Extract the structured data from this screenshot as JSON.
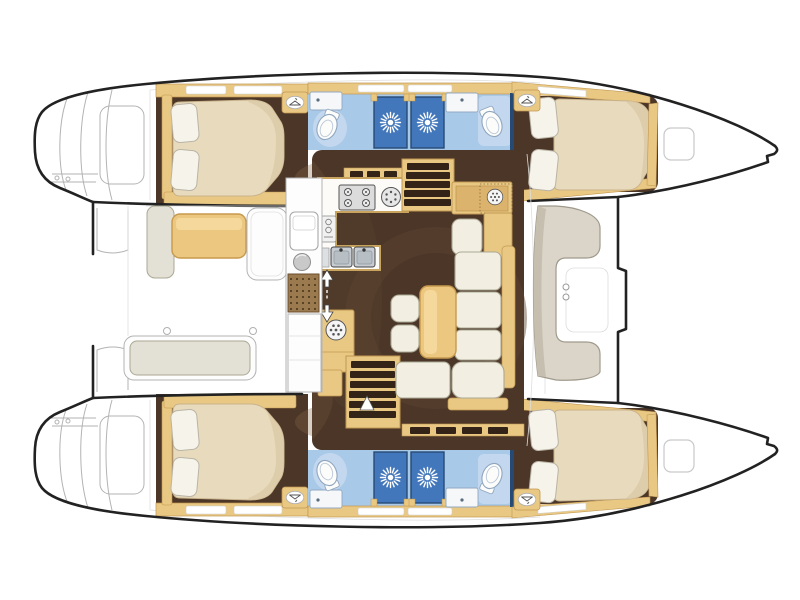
{
  "meta": {
    "label": "catamaran-interior-deck-plan",
    "view": "top-down",
    "bow_side": "right",
    "stern_side": "left"
  },
  "palette": {
    "outline": "#222222",
    "thin_line": "#b3b3b3",
    "seam": "#dedede",
    "deck_white": "#ffffff",
    "wood": "#e9c883",
    "wood_dark": "#c09752",
    "wood_hl": "#f4d89c",
    "floor": "#4b3628",
    "floor_shade": "#8a6a4c",
    "floor_deep": "#342417",
    "bed_cream": "#e8dbbd",
    "bed_edge": "#c9b28b",
    "bed_shade": "#d9c8a6",
    "pillow": "#f6f3ea",
    "pillow_edge": "#b9b4a6",
    "settee_cream": "#f2efe2",
    "settee_edge": "#aba894",
    "cushion_gray": "#e3e0d6",
    "bath_blue": "#a9c9e9",
    "bath_light": "#c3d8ee",
    "shower_blue": "#4377bb",
    "navy": "#274a74",
    "steel": "#c6ccd1",
    "panel_white": "#fdfdfd",
    "mat_brown": "#9b7a50",
    "mat_dot": "#463218"
  },
  "icons": {
    "shower_vent": "sunburst-icon",
    "wardrobe": "hanger-icon",
    "toilet": "toilet-icon",
    "stove": "burner-icon",
    "entry": "double-arrow-icon",
    "appliance": "spoked-dial-icon"
  },
  "layout": {
    "hulls": [
      {
        "name": "port-hull-top",
        "areas": [
          {
            "name": "stern-swim-platform",
            "details": [
              "transom-steps",
              "platform-rails"
            ]
          },
          {
            "name": "aft-cabin",
            "furniture": [
              "double-bed",
              "two-pillows",
              "wardrobe",
              "side-shelf",
              "overhead-lockers"
            ]
          },
          {
            "name": "aft-bathroom",
            "fixtures": [
              "sink",
              "toilet",
              "shower-stall-with-vent"
            ]
          },
          {
            "name": "forward-bathroom",
            "fixtures": [
              "shower-stall-with-vent",
              "sink",
              "toilet"
            ]
          },
          {
            "name": "forward-cabin",
            "furniture": [
              "double-bed",
              "two-pillows",
              "wardrobe",
              "footboard"
            ]
          },
          {
            "name": "bow-deck",
            "fixtures": [
              "deck-hatch",
              "anchor-notch"
            ]
          }
        ]
      },
      {
        "name": "starboard-hull-bottom",
        "mirror_of": "port-hull-top"
      }
    ],
    "bridge_deck": [
      {
        "name": "aft-cockpit",
        "furniture": [
          "side-cushion",
          "cockpit-table",
          "locker-panel",
          "aft-bench",
          "wet-bar-strip",
          "doormat",
          "mooring-rings"
        ]
      },
      {
        "name": "salon",
        "furniture": [
          "u-galley-counter",
          "stove-4-burner",
          "round-hob",
          "oven-module",
          "double-sink",
          "appliance-cabinet",
          "port-companionway-stairs",
          "starboard-companionway-stairs",
          "nav-station",
          "nav-seat",
          "l-shaped-settee",
          "salon-table",
          "stool",
          "stool",
          "entry-arrows",
          "window-slits"
        ]
      },
      {
        "name": "foredeck",
        "furniture": [
          "c-shaped-seat",
          "cup-holders",
          "front-cross-beam",
          "deck-seams"
        ]
      }
    ]
  },
  "counts": {
    "cabins": 4,
    "bathrooms": 4,
    "shower_stalls": 4,
    "toilets": 4,
    "beds": 4,
    "stairs": 2
  }
}
